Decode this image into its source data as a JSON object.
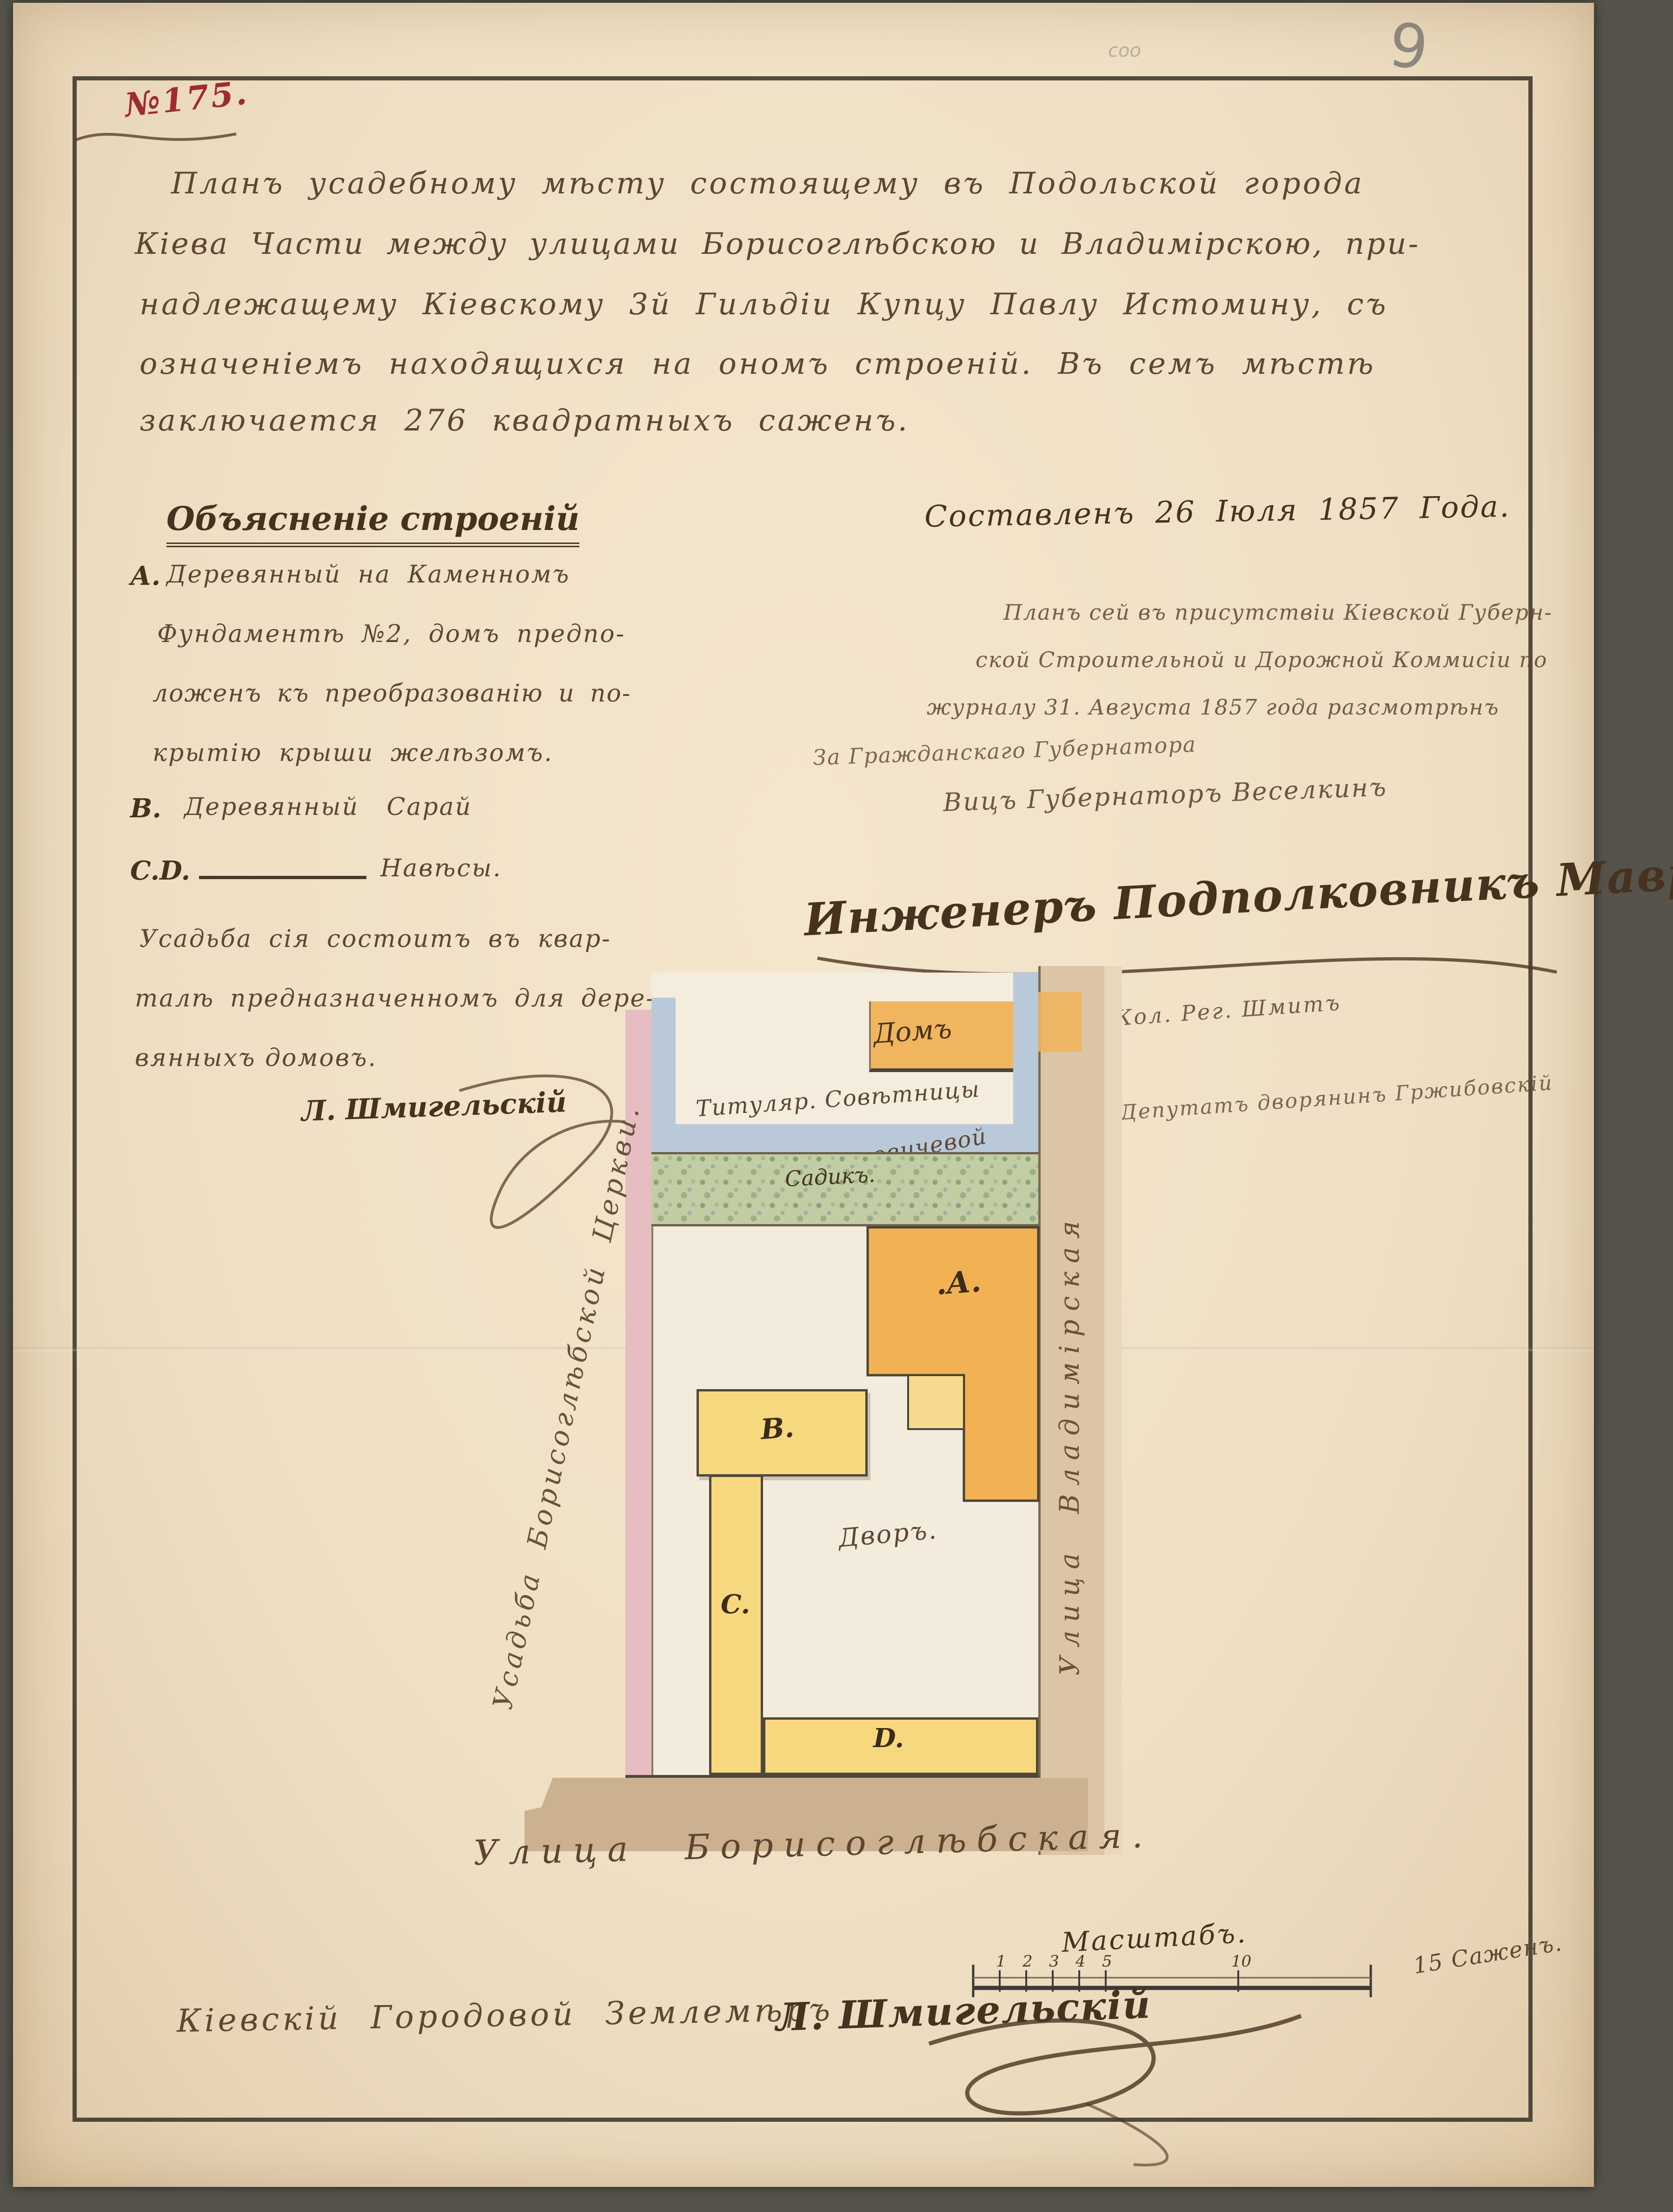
{
  "page": {
    "number_stamp": "№175.",
    "pencil_number": "9",
    "pencil_scribble": "соо"
  },
  "title": {
    "lines": [
      "Планъ усадебному мѣсту состоящему въ Подольской города",
      "Кіева Части между улицами Борисоглѣбскою и Владимірскою, при-",
      "надлежащему Кіевскому 3й Гильдіи Купцу Павлу Истомину, съ",
      "означеніемъ находящихся на ономъ строеній. Въ семъ мѣстѣ",
      "заключается 276 квадратныхъ саженъ."
    ]
  },
  "legend": {
    "header": "Объясненіе строеній",
    "a_marker": "А.",
    "a_lines": [
      "Деревянный на Каменномъ",
      "Фундаментѣ №2, домъ предпо-",
      "ложенъ къ преобразованію и по-",
      "крытію крыши желѣзомъ."
    ],
    "b_marker": "В.",
    "b_text": "Деревянный Сарай",
    "cd_marker": "C.D.",
    "cd_text": "Навѣсы.",
    "note_lines": [
      "Усадьба сія состоитъ въ квар-",
      "талѣ предназначенномъ для дере-",
      "вянныхъ домовъ."
    ],
    "signature": "Л. Шмигельскій"
  },
  "attestation": {
    "date_line": "Составленъ 26 Іюля 1857 Года.",
    "review_lines": [
      "Планъ сей въ присутствіи Кіевской Губерн-",
      "ской Строительной и Дорожной Коммисіи по",
      "журналу 31. Августа 1857 года разсмотрѣнъ"
    ],
    "for_governor": "За Гражданскаго Губернатора",
    "vice_governor": "Вицъ Губернаторъ Веселкинъ",
    "engineer_signature": "Инженеръ Подполковникъ Мавринъ",
    "clerk_signature": "Кол. Рег. Шмитъ",
    "deputy_line": "Депутатъ дворянинъ Гржибовскій"
  },
  "plan": {
    "labels": {
      "neighbor_house": "Домъ",
      "neighbor_owner_1": "Титуляр. Совѣтницы",
      "neighbor_owner_2": "Супруновичевой",
      "garden": "Садикъ.",
      "building_a": ".А.",
      "building_b": "В.",
      "building_c": "C.",
      "building_d": "D.",
      "courtyard": "Дворъ.",
      "left_boundary": "Усадьба Борисоглѣбской Церкви.",
      "street_right": "Улица Владимірская",
      "street_bottom": "Улица Борисоглѣбская."
    },
    "colors": {
      "building_main": "#f2b254",
      "building_wood": "#f8d87e",
      "annex": "#f7da8d",
      "garden": "#c2cda4",
      "boundary_pink": "#e6bdc1",
      "neighbor_blue": "#bac9da",
      "street_tan": "#dbc5a6",
      "street_brown": "#ccb190"
    }
  },
  "scale": {
    "label": "Масштабъ.",
    "ticks": [
      "1",
      "2",
      "3",
      "4",
      "5",
      "10"
    ],
    "end_label": "15 Саженъ."
  },
  "footer": {
    "title": "Кіевскій Городовой Землемѣръ",
    "signature": "Л. Шмигельскій"
  }
}
